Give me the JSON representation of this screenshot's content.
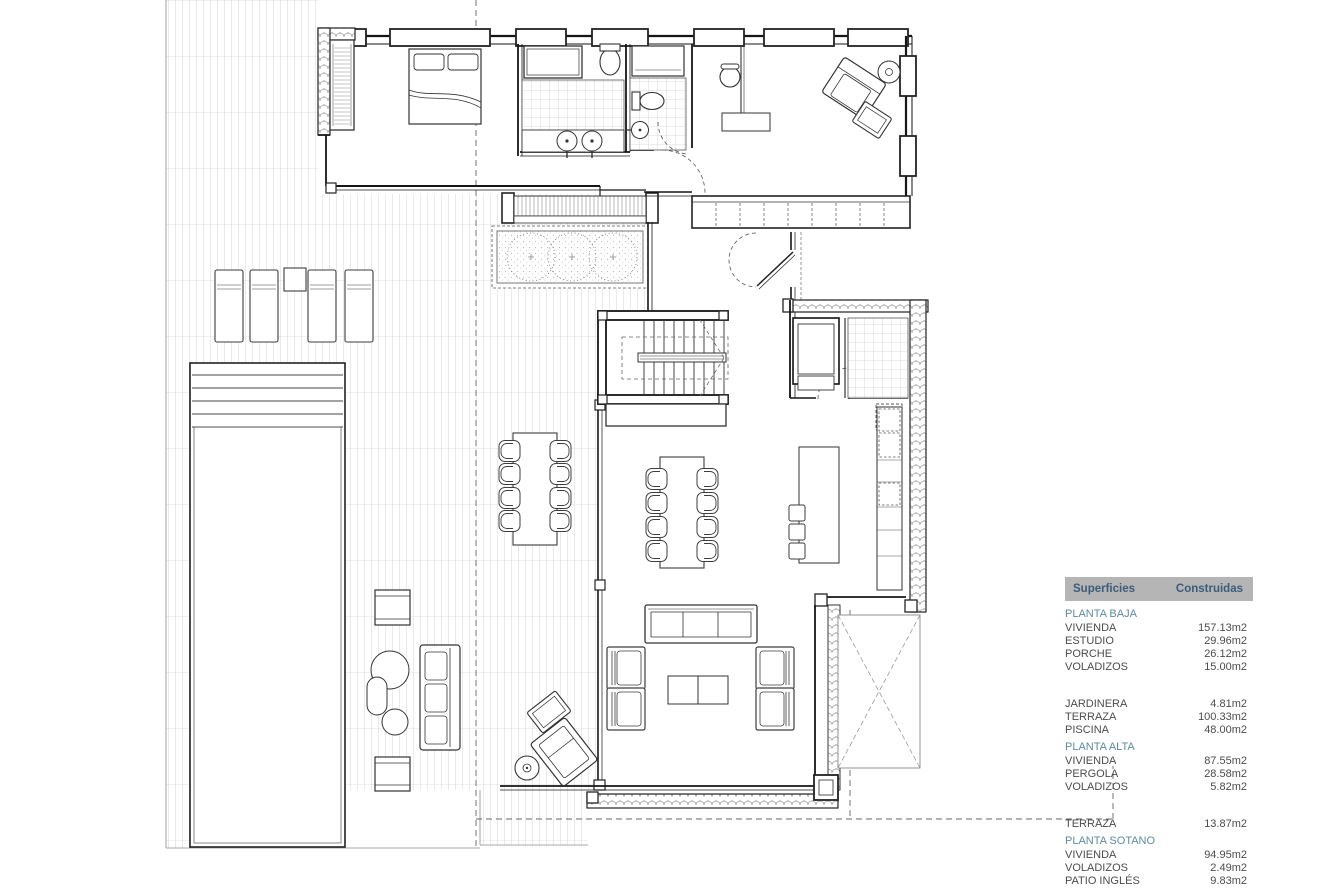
{
  "surfaces_table": {
    "header": {
      "col1": "Superficies",
      "col2": "Construidas"
    },
    "sections": [
      {
        "title": "PLANTA BAJA",
        "gap": false,
        "rows": [
          {
            "label": "VIVIENDA",
            "value": "157.13m2"
          },
          {
            "label": "ESTUDIO",
            "value": "29.96m2"
          },
          {
            "label": "PORCHE",
            "value": "26.12m2"
          },
          {
            "label": "VOLADIZOS",
            "value": "15.00m2"
          }
        ]
      },
      {
        "title": "",
        "gap": true,
        "rows": [
          {
            "label": "JARDINERA",
            "value": "4.81m2"
          },
          {
            "label": "TERRAZA",
            "value": "100.33m2"
          },
          {
            "label": "PISCINA",
            "value": "48.00m2"
          }
        ]
      },
      {
        "title": "PLANTA ALTA",
        "gap": false,
        "rows": [
          {
            "label": "VIVIENDA",
            "value": "87.55m2"
          },
          {
            "label": "PERGOLA",
            "value": "28.58m2"
          },
          {
            "label": "VOLADIZOS",
            "value": "5.82m2"
          }
        ]
      },
      {
        "title": "",
        "gap": true,
        "rows": [
          {
            "label": "TERRAZA",
            "value": "13.87m2"
          }
        ]
      },
      {
        "title": "PLANTA SOTANO",
        "gap": false,
        "rows": [
          {
            "label": "VIVIENDA",
            "value": "94.95m2"
          },
          {
            "label": "VOLADIZOS",
            "value": "2.49m2"
          },
          {
            "label": "PATIO INGLÉS",
            "value": "9.83m2"
          }
        ]
      }
    ],
    "footer": "ACABADOS EXTERIORES"
  },
  "colors": {
    "header_bg": "#b5b5b5",
    "header_text": "#3d5c79",
    "section_title": "#5d8ba1",
    "row_text": "#4c4c4c",
    "wall_line": "#161616"
  }
}
